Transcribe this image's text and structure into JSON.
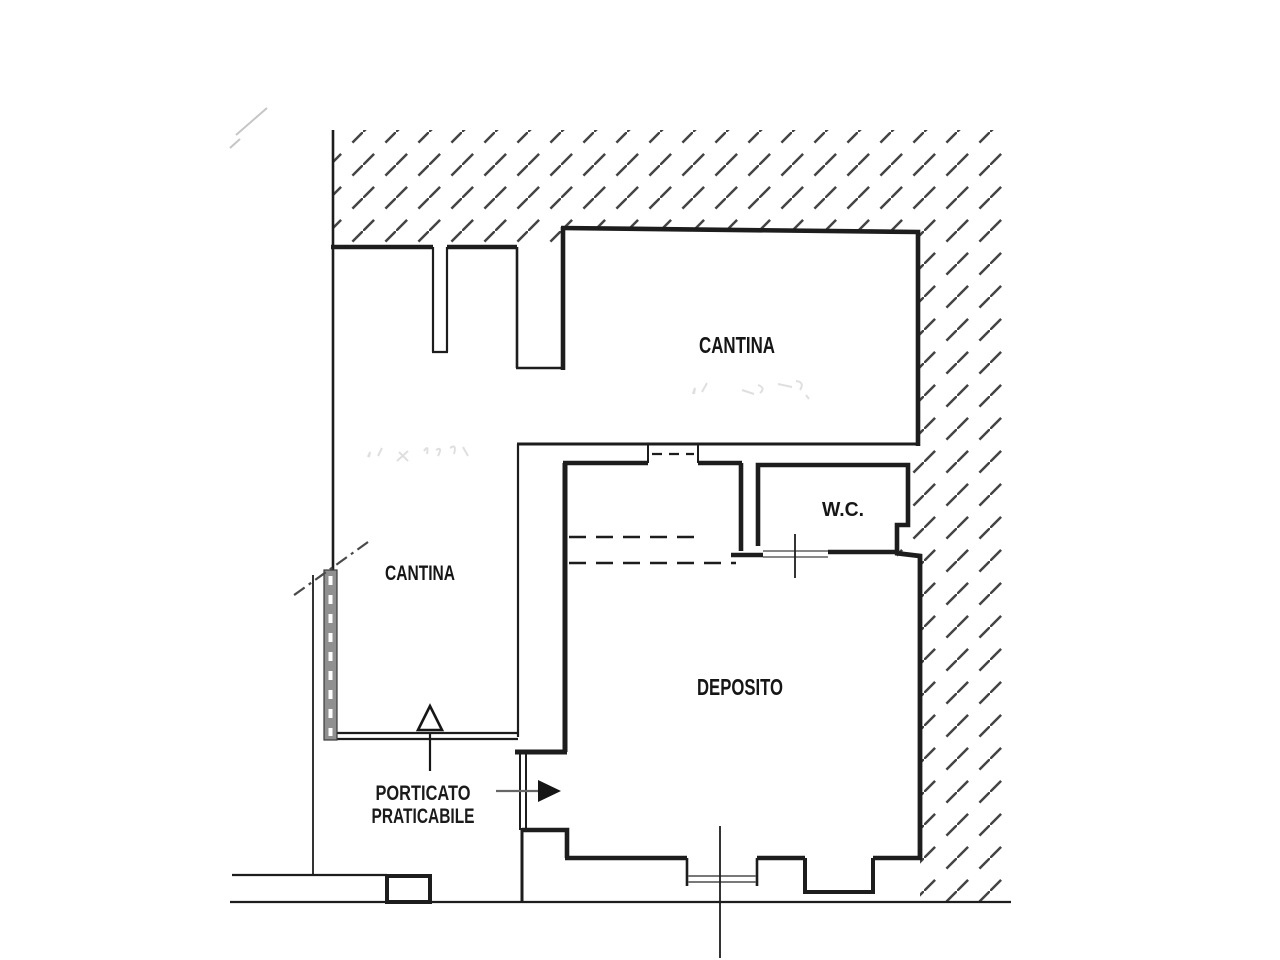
{
  "document": {
    "kind": "scanned cadastral floor plan"
  },
  "rooms": {
    "cantina_upper": {
      "label": "CANTINA"
    },
    "cantina_left": {
      "label": "CANTINA"
    },
    "wc": {
      "label": "W.C."
    },
    "deposito": {
      "label": "DEPOSITO"
    }
  },
  "annotations": {
    "porticato": {
      "line1": "PORTICATO",
      "line2": "PRATICABILE"
    }
  },
  "icons": {
    "entrance_arrow": "right-solid-arrow",
    "door_marker": "up-triangle-arrow",
    "boundary_line": "dash-dot-diagonal"
  },
  "colors": {
    "background": "#ffffff",
    "line": "#1d1d1d",
    "hatch": "#2f2f2f",
    "gray_wall": "#909090",
    "pencil": "#9e9e9e",
    "arrow_line": "#666666"
  }
}
